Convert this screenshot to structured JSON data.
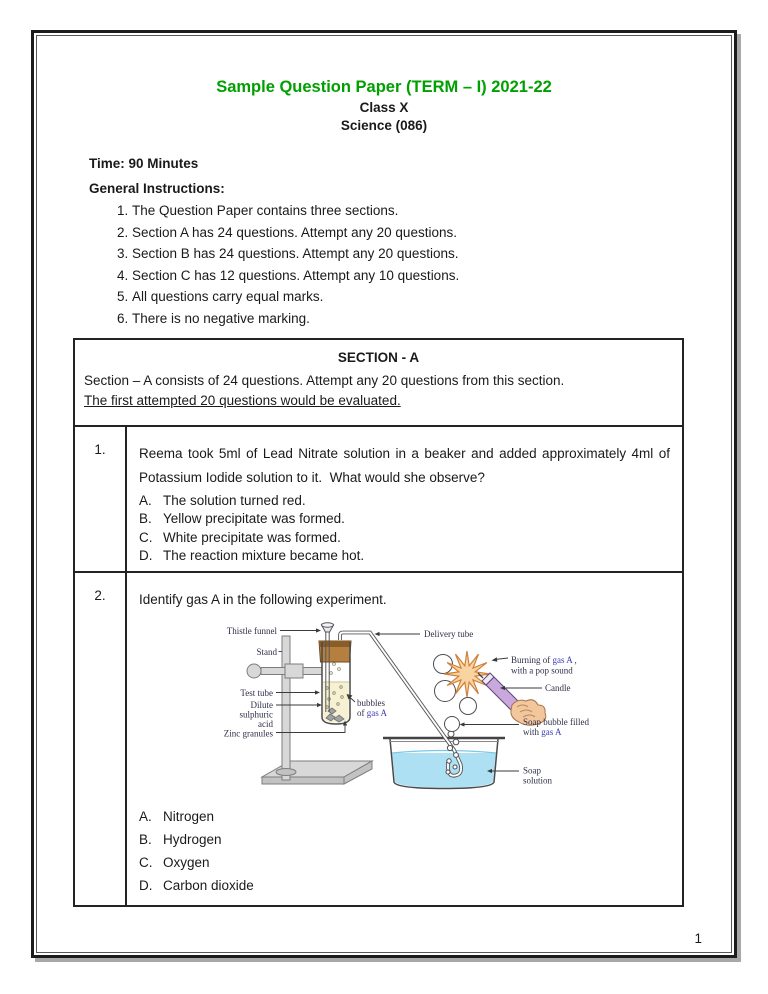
{
  "page": {
    "number": "1"
  },
  "header": {
    "title": "Sample Question Paper (TERM – I) 2021-22",
    "class_line": "Class X",
    "subject_line": "Science (086)",
    "time_label": "Time: 90 Minutes"
  },
  "instructions": {
    "heading": "General Instructions:",
    "items": [
      "The Question Paper contains three sections.",
      "Section A has 24 questions. Attempt any 20 questions.",
      "Section B has 24 questions. Attempt any 20 questions.",
      "Section C has 12 questions. Attempt any 10 questions.",
      "All questions carry equal marks.",
      "There is no negative marking."
    ]
  },
  "section": {
    "title": "SECTION - A",
    "description": "Section – A consists of 24 questions. Attempt any 20 questions from this section.",
    "note": "The first attempted 20 questions would be evaluated."
  },
  "questions": [
    {
      "number": "1.",
      "text": "Reema took 5ml of Lead Nitrate solution in a beaker and added approximately 4ml of Potassium Iodide solution to it.  What would she observe?",
      "options": [
        {
          "letter": "A.",
          "text": "The solution turned red."
        },
        {
          "letter": "B.",
          "text": "Yellow precipitate was formed."
        },
        {
          "letter": "C.",
          "text": "White precipitate was formed."
        },
        {
          "letter": "D.",
          "text": "The reaction mixture became hot."
        }
      ]
    },
    {
      "number": "2.",
      "text": "Identify gas A in the following experiment.",
      "options": [
        {
          "letter": "A.",
          "text": "Nitrogen"
        },
        {
          "letter": "B.",
          "text": "Hydrogen"
        },
        {
          "letter": "C.",
          "text": "Oxygen"
        },
        {
          "letter": "D.",
          "text": "Carbon dioxide"
        }
      ],
      "diagram_labels": {
        "thistle_funnel": "Thistle funnel",
        "stand": "Stand",
        "test_tube": "Test tube",
        "dilute_line1": "Dilute",
        "dilute_line2": "sulphuric",
        "dilute_line3": "acid",
        "zinc_granules": "Zinc granules",
        "bubbles_line1": "bubbles",
        "bubbles_line2_prefix": "of ",
        "gas_a": "gas A",
        "delivery_tube": "Delivery tube",
        "burning_prefix": "Burning of ",
        "burning_comma": " ,",
        "burning_line2": "with a pop sound",
        "candle": "Candle",
        "soap_bubble_line1": "Soap bubble filled",
        "soap_bubble_line2_prefix": "with ",
        "soap_line1": "Soap",
        "soap_line2": "solution"
      }
    }
  ],
  "colors": {
    "accent": "#00a000",
    "ink": "#1a1a1a",
    "frame": "#1c1c1c",
    "frame_shadow": "#a8a8a8",
    "diagram_label": "#2f2f48",
    "gas_a_blue": "#3a3ab8",
    "cork": "#b5803f",
    "cork_dark": "#8a5c26",
    "liquid": "#f7f1d4",
    "water": "#aee0f4",
    "burst_fill": "#f7d4a0",
    "burst_edge": "#d0803a",
    "candle_fill": "#c9a8de",
    "candle_edge": "#5d4a77",
    "skin": "#f2c79e",
    "skin_edge": "#a9744a"
  }
}
